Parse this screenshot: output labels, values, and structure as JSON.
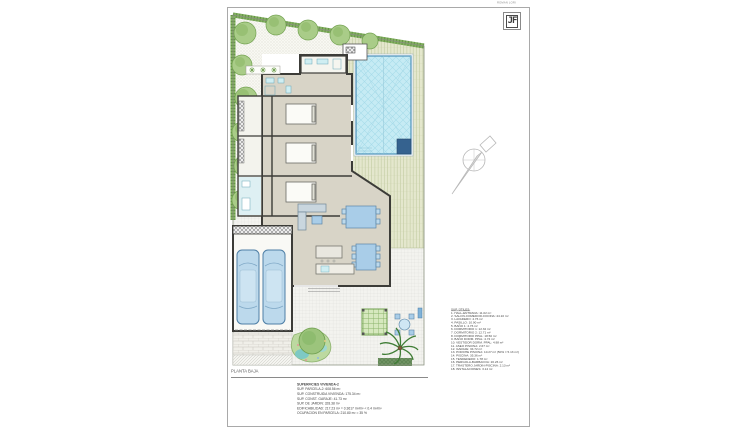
{
  "title_block": {
    "caption": "ROMAN LORI",
    "logo_text": "JF"
  },
  "legend": {
    "title": "SUP. ÚTILES:",
    "items": [
      "1. HALL-ENTRADA: 11.02 m²",
      "2. SALON-COMEDOR-COCINA: 44.10 m²",
      "3. LAVADERO: 4.76 m²",
      "4. PASILLO: 10.90 m²",
      "5. BAÑO 1: 4.76 m²",
      "6. DORMITORIO 1: 12.32 m²",
      "7. DORMITORIO 2: 12.71 m²",
      "8. DORMITORIO PPAL: 18.50 m²",
      "9. BAÑO DORM. PPAL: 4.74 m²",
      "10. VESTIDOR DORM. PPAL: 4.98 m²",
      "11. ASEO PISCINA: 2.67 m²",
      "12. GARAJE: 34.72 m²",
      "13. PORCHE PISCINA: 10.27 m² (50% = 5.13 m²)",
      "14. PISCINA: 35.36 m²",
      "15. TENDEDERO: 1.78 m²",
      "16. PERGOLA-BARBACOA: 20.26 m²",
      "17. TRASTERO JARDIN-PISCINA: 2.13 m²",
      "18. INSTALACIONES: 3.14 m²"
    ]
  },
  "summary": {
    "title": "SUPERFICIES VIVIENDA-2",
    "lines": [
      "SUP. PARCELA-2: 608.56 m²",
      "SUP. CONSTRUIDA VIVIENDA: 175.34 m²",
      "SUP. CONST. GARAJE: 41.73 m²",
      "SUP. DE JARDIN: 328.38 m²",
      "EDIFICABILIDAD: 217.23 m² = 0.3617 m²/m² < 0.4 m²/m²",
      "OCUPACION EN PARCELA: 210.80 m² = 35 %"
    ]
  },
  "plan_label": "PLANTA BAJA",
  "colors": {
    "pool_water": "#c6ebf4",
    "pool_border": "#4a90b8",
    "pool_dark_step": "#35628f",
    "hedge_green": "#83b060",
    "tree_green": "#a9cc88",
    "deck_wood": "#e4e7cd",
    "house_floor": "#d8d4c7",
    "wall": "#3c3c38",
    "furniture_blue": "#a9cde8",
    "car_blue": "#bcd9ec",
    "palm_green": "#3f7d35"
  }
}
